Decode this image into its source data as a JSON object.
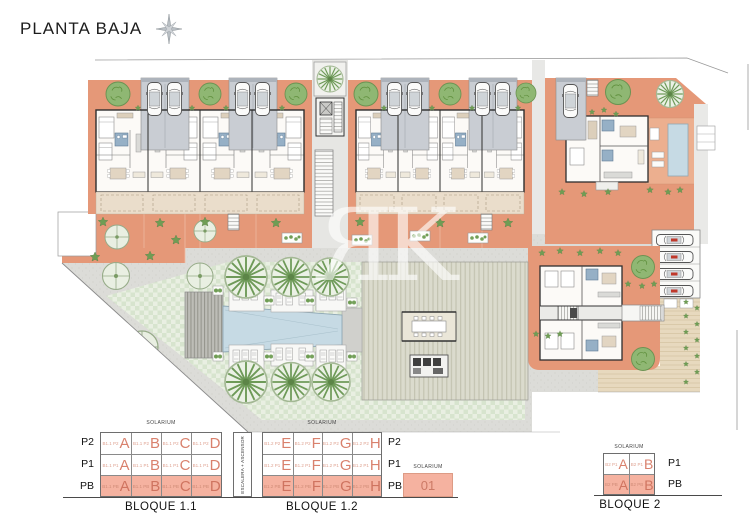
{
  "title": "PLANTA BAJA",
  "watermark": {
    "letter_mirrored": "R",
    "letter": "K"
  },
  "legend": {
    "solarium_label": "SOLARIUM",
    "escalera_label": "ESCALERA + ASCENSOR",
    "b11": {
      "name": "BLOQUE 1.1",
      "row_labels": [
        "P2",
        "P1",
        "PB"
      ],
      "rows": [
        {
          "cells": [
            {
              "code": "B1.1 P2",
              "letter": "A"
            },
            {
              "code": "B1.1 P2",
              "letter": "B"
            },
            {
              "code": "B1.1 P2",
              "letter": "C"
            },
            {
              "code": "B1.1 P2",
              "letter": "D"
            }
          ]
        },
        {
          "cells": [
            {
              "code": "B1.1 P1",
              "letter": "A"
            },
            {
              "code": "B1.1 P1",
              "letter": "B"
            },
            {
              "code": "B1.1 P1",
              "letter": "C"
            },
            {
              "code": "B1.1 P1",
              "letter": "D"
            }
          ]
        },
        {
          "cells": [
            {
              "code": "B1.1 PB",
              "letter": "A"
            },
            {
              "code": "B1.1 PB",
              "letter": "B"
            },
            {
              "code": "B1.1 PB",
              "letter": "C"
            },
            {
              "code": "B1.1 PB",
              "letter": "D"
            }
          ]
        }
      ]
    },
    "b12": {
      "name": "BLOQUE 1.2",
      "row_labels": [
        "P2",
        "P1",
        "PB"
      ],
      "rows": [
        {
          "cells": [
            {
              "code": "B1.2 P2",
              "letter": "E"
            },
            {
              "code": "B1.2 P2",
              "letter": "F"
            },
            {
              "code": "B1.2 P2",
              "letter": "G"
            },
            {
              "code": "B1.2 P2",
              "letter": "H"
            }
          ]
        },
        {
          "cells": [
            {
              "code": "B1.2 P1",
              "letter": "E"
            },
            {
              "code": "B1.2 P1",
              "letter": "F"
            },
            {
              "code": "B1.2 P1",
              "letter": "G"
            },
            {
              "code": "B1.2 P1",
              "letter": "H"
            }
          ]
        },
        {
          "cells": [
            {
              "code": "B1.2 PB",
              "letter": "E"
            },
            {
              "code": "B1.2 PB",
              "letter": "F"
            },
            {
              "code": "B1.2 PB",
              "letter": "G"
            },
            {
              "code": "B1.2 PB",
              "letter": "H"
            }
          ]
        }
      ]
    },
    "annex": {
      "solarium_label": "SOLARIUM",
      "unit": "01"
    },
    "b2": {
      "name": "BLOQUE 2",
      "row_labels": [
        "P1",
        "PB"
      ],
      "rows": [
        {
          "cells": [
            {
              "code": "B2 P1",
              "letter": "A"
            },
            {
              "code": "B2 P1",
              "letter": "B"
            }
          ]
        },
        {
          "cells": [
            {
              "code": "B2 PB",
              "letter": "A"
            },
            {
              "code": "B2 PB",
              "letter": "B"
            }
          ]
        }
      ]
    }
  },
  "colors": {
    "terrace_salmon": "#E59878",
    "pb_highlight": "#F5B2A0",
    "unit_letter": "#D9816D",
    "pool_blue": "#C6DAE4",
    "lawn_green": "#E9EFE2",
    "garage_grey": "#C9CDD3",
    "tan_path": "#E7D9BE"
  }
}
